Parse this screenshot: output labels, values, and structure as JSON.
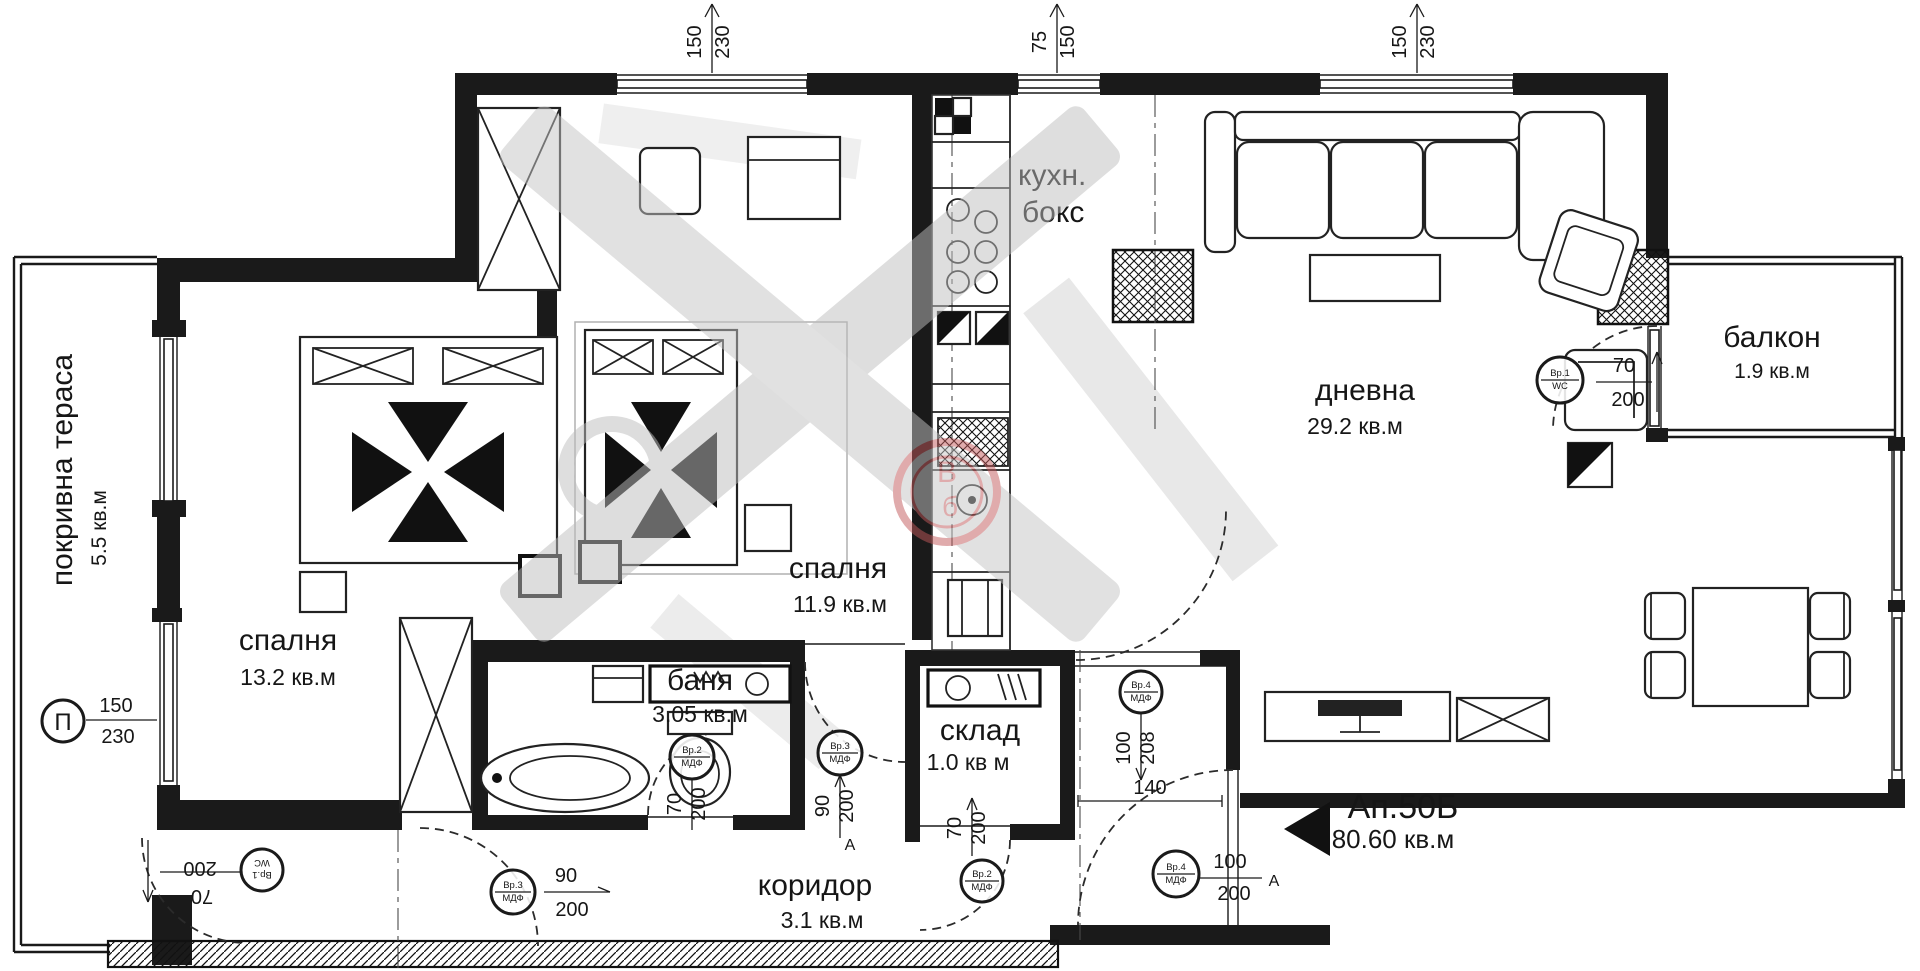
{
  "rooms": [
    {
      "name": "покривна тераса",
      "area": "5.5 кв.м"
    },
    {
      "name": "спалня",
      "area": "13.2 кв.м"
    },
    {
      "name": "спалня",
      "area": "11.9 кв.м"
    },
    {
      "name": "баня",
      "area": "3.05 кв.м"
    },
    {
      "name": "склад",
      "area": "1.0 кв м"
    },
    {
      "name": "коридор",
      "area": "3.1 кв.м"
    },
    {
      "name": "дневна",
      "area": "29.2 кв.м"
    },
    {
      "name": "балкон",
      "area": "1.9 кв.м"
    }
  ],
  "kitchen_label": {
    "line1": "кухн.",
    "line2": "бокс"
  },
  "apartment": {
    "number": "Ап.50Б",
    "area": "80.60 кв.м"
  },
  "dims": {
    "top": [
      {
        "num": "150",
        "den": "230"
      },
      {
        "num": "75",
        "den": "150"
      },
      {
        "num": "150",
        "den": "230"
      }
    ],
    "terrace_window": {
      "mark": "П",
      "num": "150",
      "den": "230"
    },
    "pass_width": "140"
  },
  "doors": [
    {
      "code": "Вр.1",
      "spec": "WC",
      "num": "70",
      "den": "200",
      "suffix": ""
    },
    {
      "code": "Вр.2",
      "spec": "МДФ",
      "num": "70",
      "den": "200",
      "suffix": ""
    },
    {
      "code": "Вр.3",
      "spec": "МДФ",
      "num": "90",
      "den": "200",
      "suffix": "А"
    },
    {
      "code": "Вр.2",
      "spec": "МДФ",
      "num": "70",
      "den": "200",
      "suffix": ""
    },
    {
      "code": "Вр.4",
      "spec": "МДФ",
      "num": "100",
      "den": "208",
      "suffix": ""
    },
    {
      "code": "Вр.4",
      "spec": "МДФ",
      "num": "100",
      "den": "200",
      "suffix": "А"
    },
    {
      "code": "Вр.1",
      "spec": "WC",
      "num": "70",
      "den": "200",
      "suffix": ""
    },
    {
      "code": "Вр.3",
      "spec": "МДФ",
      "num": "90",
      "den": "200",
      "suffix": ""
    }
  ],
  "watermark": {
    "letter1": "В",
    "letter2": "б"
  }
}
